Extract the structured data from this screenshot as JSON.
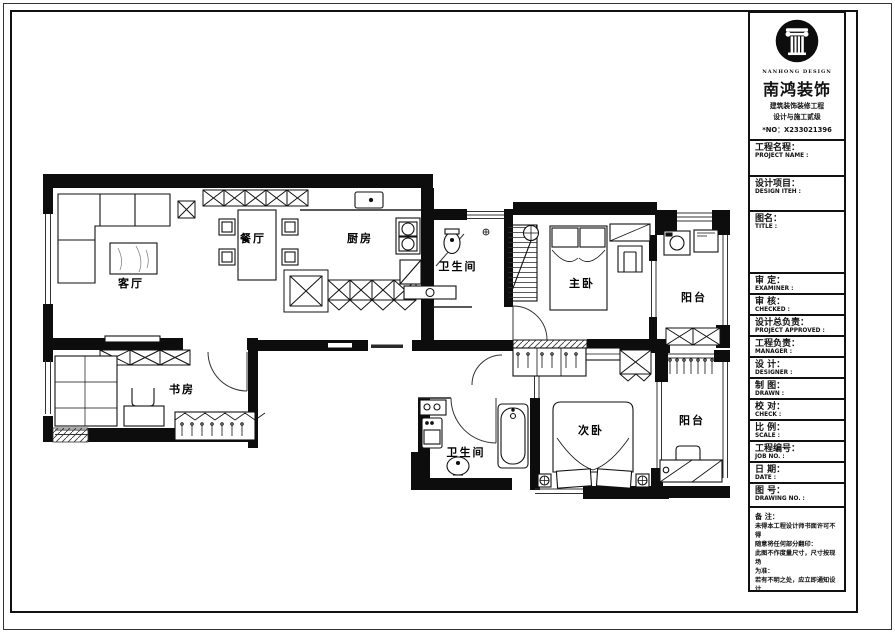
{
  "sheet": {
    "company": {
      "logo_caption": "NANHONG DESIGN",
      "name": "南鸿装饰",
      "cert_line1": "建筑装饰装修工程",
      "cert_line2": "设计与施工贰级",
      "cert_no": "*NO：X233021396"
    },
    "title_block": {
      "fields": [
        {
          "key": "project-name",
          "zh": "工程名程：",
          "en": "PROJECT NAME :",
          "value": "",
          "h": 36
        },
        {
          "key": "design-item",
          "zh": "设计项目：",
          "en": "DESIGN ITEH :",
          "value": "",
          "h": 35
        },
        {
          "key": "title",
          "zh": "图名：",
          "en": "TITLE :",
          "value": "",
          "h": 62
        },
        {
          "key": "examiner",
          "zh": "审 定：",
          "en": "EXAMINER :",
          "value": "",
          "h": 21
        },
        {
          "key": "checked",
          "zh": "审 核：",
          "en": "CHECKED :",
          "value": "",
          "h": 21
        },
        {
          "key": "project-approved",
          "zh": "设计总负责：",
          "en": "PROJECT APPROVED :",
          "value": "",
          "h": 21
        },
        {
          "key": "manager",
          "zh": "工程负责：",
          "en": "MANAGER :",
          "value": "",
          "h": 21
        },
        {
          "key": "designer",
          "zh": "设 计：",
          "en": "DESIGNER :",
          "value": "",
          "h": 21
        },
        {
          "key": "drawn",
          "zh": "制 图：",
          "en": "DRAWN :",
          "value": "",
          "h": 21
        },
        {
          "key": "check",
          "zh": "校 对：",
          "en": "CHECK :",
          "value": "",
          "h": 21
        },
        {
          "key": "scale",
          "zh": "比 例：",
          "en": "SCALE :",
          "value": "",
          "h": 21
        },
        {
          "key": "job-no",
          "zh": "工程编号：",
          "en": "JOB NO. :",
          "value": "",
          "h": 21
        },
        {
          "key": "date",
          "zh": "日 期：",
          "en": "DATE :",
          "value": "",
          "h": 21
        },
        {
          "key": "drawing-no",
          "zh": "图 号：",
          "en": "DRAWING NO. :",
          "value": "",
          "h": 24
        }
      ],
      "notes": {
        "title": "备 注：",
        "lines": [
          "未得本工程设计师书面许可不得",
          "随意将任何部分翻印：",
          "此图不作度量尺寸，尺寸按现场",
          "为准：",
          "若有不明之处，应立即通知设计",
          "师."
        ],
        "fine_print": "本设计版权归设计师所有",
        "phone": "免费咨询电话:400 8383 168"
      }
    },
    "floor_plan": {
      "rooms": [
        {
          "id": "living-room",
          "label": "客厅",
          "x": 131,
          "y": 283
        },
        {
          "id": "dining-room",
          "label": "餐厅",
          "x": 253,
          "y": 238
        },
        {
          "id": "kitchen",
          "label": "厨房",
          "x": 360,
          "y": 238
        },
        {
          "id": "bathroom-upper",
          "label": "卫生间",
          "x": 458,
          "y": 266
        },
        {
          "id": "master-bedroom",
          "label": "主卧",
          "x": 582,
          "y": 283
        },
        {
          "id": "balcony-upper",
          "label": "阳台",
          "x": 694,
          "y": 297
        },
        {
          "id": "study",
          "label": "书房",
          "x": 182,
          "y": 389
        },
        {
          "id": "bathroom-lower",
          "label": "卫生间",
          "x": 466,
          "y": 452
        },
        {
          "id": "second-bedroom",
          "label": "次卧",
          "x": 591,
          "y": 430
        },
        {
          "id": "balcony-lower",
          "label": "阳台",
          "x": 692,
          "y": 420
        }
      ]
    }
  }
}
